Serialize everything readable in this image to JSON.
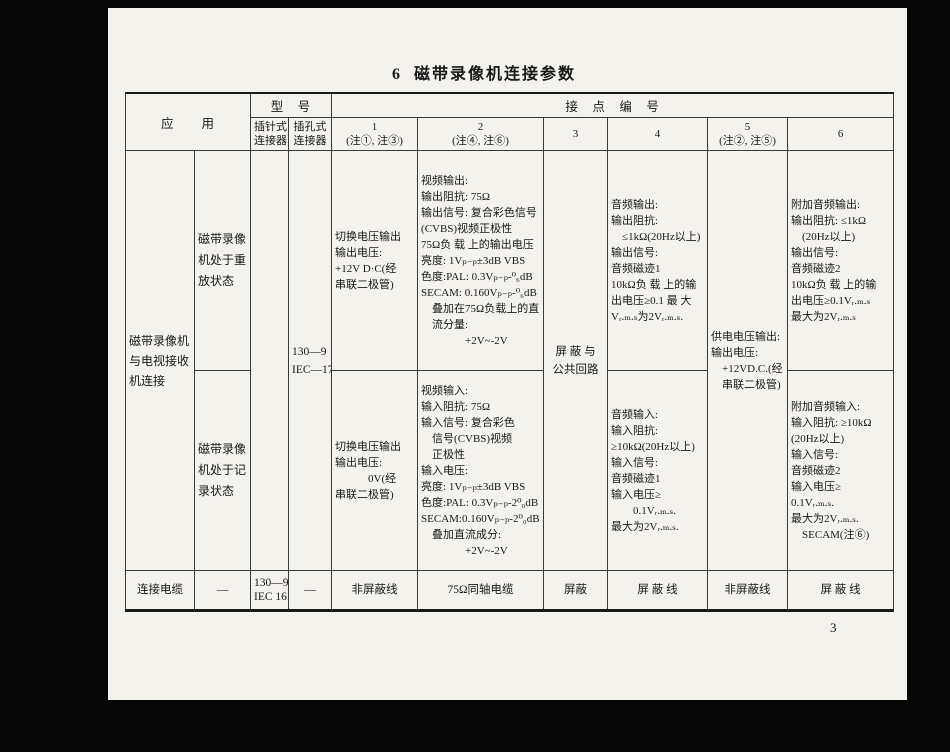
{
  "page": {
    "title": "6  磁带录像机连接参数",
    "page_number": "3"
  },
  "table": {
    "header": {
      "application": "应　　用",
      "model": "型　号",
      "contact_numbers": "接　点　编　号",
      "pin_connector": [
        "插针式",
        "连接器"
      ],
      "jack_connector": [
        "插孔式",
        "连接器"
      ],
      "contacts": [
        [
          "1",
          "(注①, 注③)"
        ],
        [
          "2",
          "(注④, 注⑥)"
        ],
        [
          "3"
        ],
        [
          "4"
        ],
        [
          "5",
          "(注②, 注⑤)"
        ],
        [
          "6"
        ]
      ]
    },
    "body": {
      "application": [
        "磁带录像机",
        "与电视接收",
        "机连接"
      ],
      "model_jack": [
        "130—9",
        "IEC—17"
      ],
      "shield_common": [
        "屏 蔽 与",
        "公共回路"
      ],
      "supply": [
        "供电电压输出:",
        "输出电压:",
        "　+12VD.C.(经",
        "　串联二极管)"
      ],
      "playback": {
        "state": [
          "磁带录像",
          "机处于重",
          "放状态"
        ],
        "contact1": [
          "切换电压输出",
          "输出电压:",
          "+12V D·C(经",
          "串联二极管)"
        ],
        "contact2": [
          "视频输出:",
          "输出阻抗: 75Ω",
          "输出信号: 复合彩色信号",
          "(CVBS)视频正极性",
          "75Ω负 载 上的输出电压",
          "亮度: 1Vₚ₋ₚ±3dB VBS",
          "色度:PAL: 0.3Vₚ₋ₚ-⁰₆dB",
          "SECAM: 0.160Vₚ₋ₚ-⁰₆dB",
          "　叠加在75Ω负载上的直",
          "　流分量:",
          "　　　　+2V~-2V"
        ],
        "contact4": [
          "音频输出:",
          "输出阻抗:",
          "　≤1kΩ(20Hz以上)",
          "输出信号:",
          "音频磁迹1",
          "10kΩ负 载 上的输",
          "出电压≥0.1 最 大",
          "Vᵣ.ₘ.ₛ为2Vᵣ.ₘ.ₛ."
        ],
        "contact6": [
          "附加音频输出:",
          "输出阻抗: ≤1kΩ",
          "　(20Hz以上)",
          "输出信号:",
          "音频磁迹2",
          "10kΩ负 载 上的输",
          "出电压≥0.1Vᵣ.ₘ.ₛ",
          "最大为2Vᵣ.ₘ.ₛ"
        ]
      },
      "record": {
        "state": [
          "磁带录像",
          "机处于记",
          "录状态"
        ],
        "contact1": [
          "切换电压输出",
          "输出电压:",
          "　　　0V(经",
          "串联二极管)"
        ],
        "contact2": [
          "视频输入:",
          "输入阻抗: 75Ω",
          "输入信号: 复合彩色",
          "　信号(CVBS)视频",
          "　正极性",
          "输入电压:",
          "亮度: 1Vₚ₋ₚ±3dB VBS",
          "色度:PAL: 0.3Vₚ₋ₚ-2⁰₀dB",
          "SECAM:0.160Vₚ₋ₚ-2⁰₀dB",
          "　叠加直流成分:",
          "　　　　+2V~-2V"
        ],
        "contact4": [
          "音频输入:",
          "输入阻抗:",
          "≥10kΩ(20Hz以上)",
          "输入信号:",
          "音频磁迹1",
          "输入电压≥",
          "　　0.1Vᵣ.ₘ.ₛ.",
          "最大为2Vᵣ.ₘ.ₛ."
        ],
        "contact6": [
          "附加音频输入:",
          "输入阻抗: ≥10kΩ",
          "(20Hz以上)",
          "输入信号:",
          "音频磁迹2",
          "输入电压≥",
          "0.1Vᵣ.ₘ.ₛ.",
          "最大为2Vᵣ.ₘ.ₛ.",
          "　SECAM(注⑥)"
        ]
      }
    },
    "cable": {
      "label": "连接电缆",
      "cells": [
        "—",
        [
          "130—9",
          "IEC 16"
        ],
        "—",
        "非屏蔽线",
        "75Ω同轴电缆",
        "屏蔽",
        "屏 蔽 线",
        "非屏蔽线",
        "屏 蔽 线"
      ]
    }
  }
}
